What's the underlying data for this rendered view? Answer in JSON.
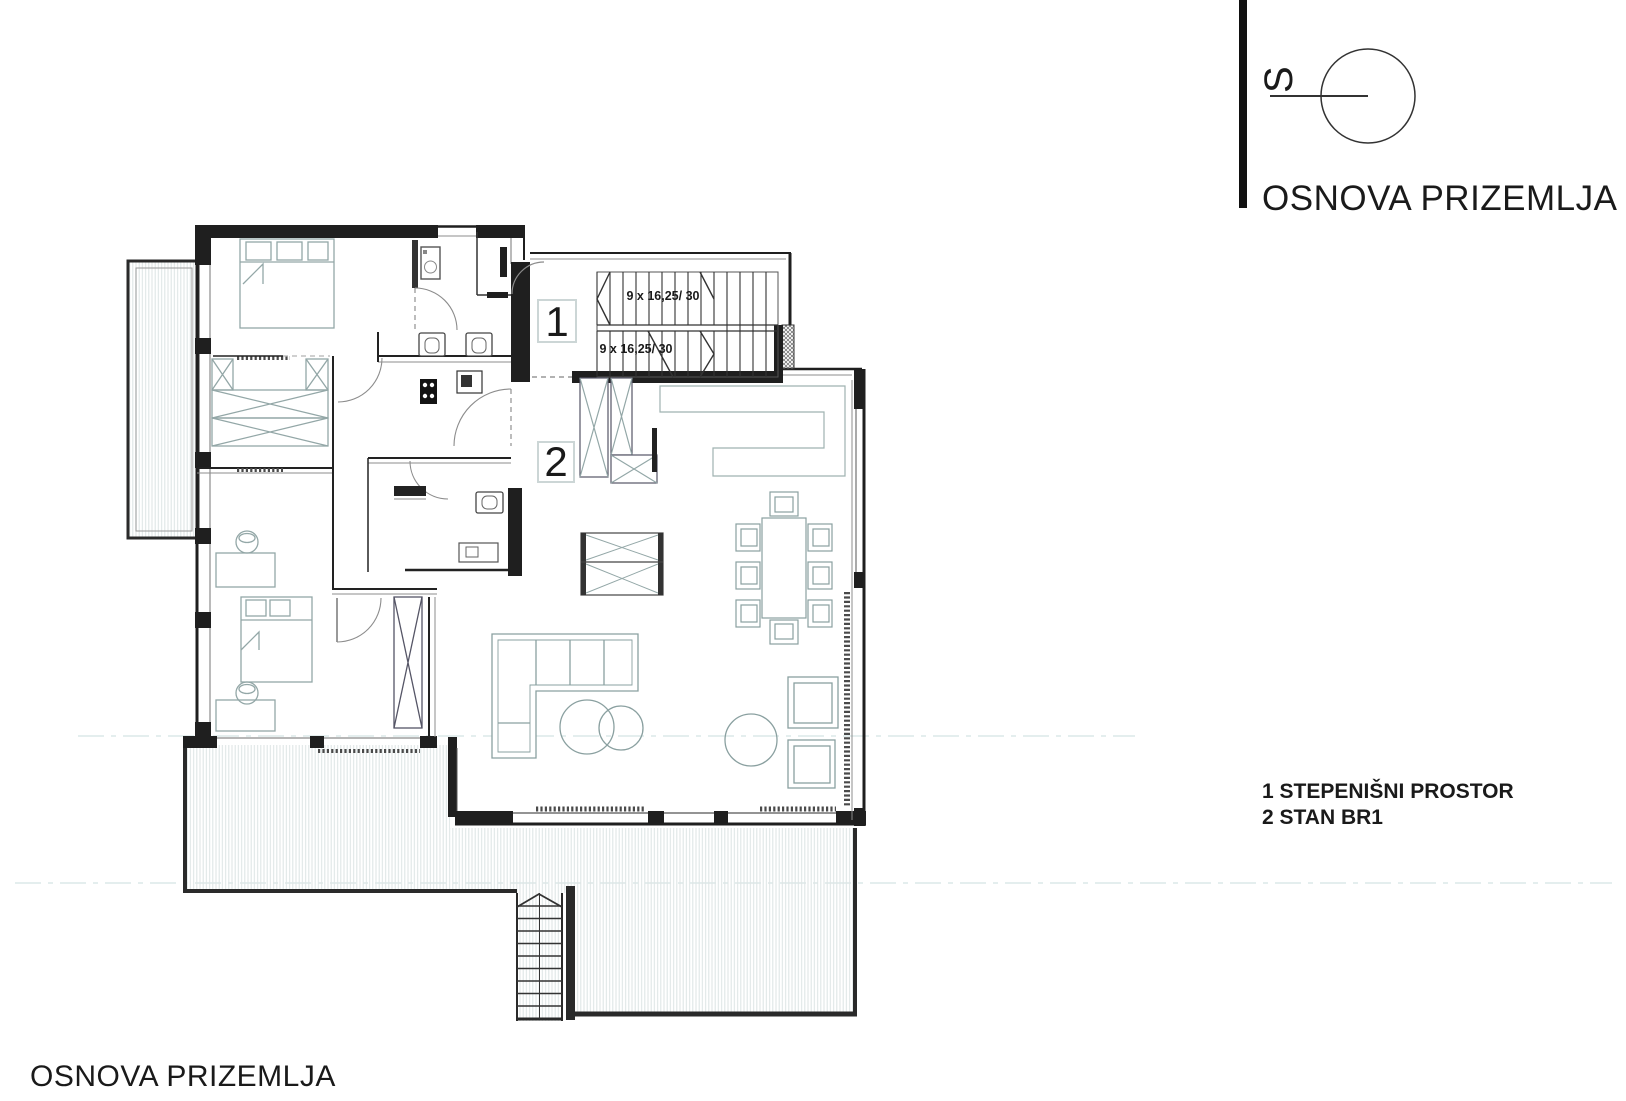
{
  "titles": {
    "top_right": "OSNOVA PRIZEMLJA",
    "bottom_left": "OSNOVA PRIZEMLJA"
  },
  "north_indicator": {
    "letter": "S"
  },
  "legend": {
    "items": [
      "1 STEPENIŠNI PROSTOR",
      "2 STAN BR1"
    ]
  },
  "plan": {
    "room_labels": {
      "stairwell": "1",
      "apartment": "2"
    },
    "stair_annotation_upper": "9 x 16,25/ 30",
    "stair_annotation_lower": "9 x 16,25/ 30"
  },
  "colors": {
    "wall": "#1f1f1f",
    "furniture": "#93a7a7",
    "hatch": "#dfe5e5",
    "text": "#1a1a1a"
  }
}
